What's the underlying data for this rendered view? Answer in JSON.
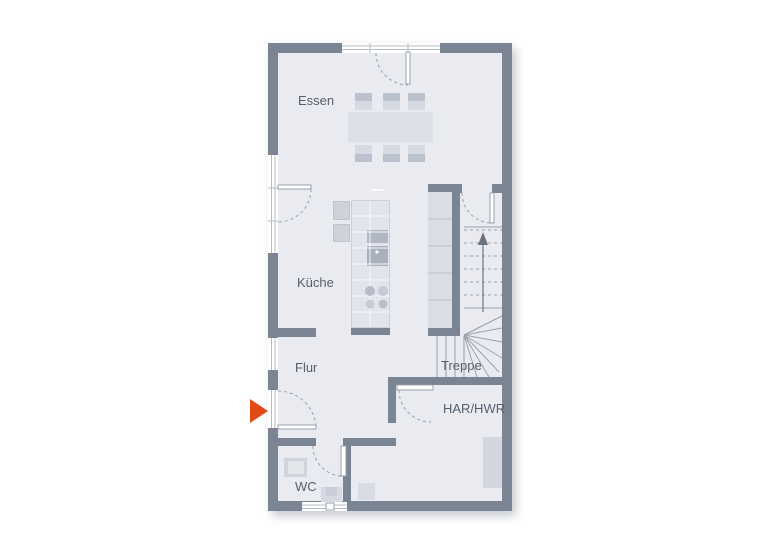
{
  "floorplan": {
    "rooms": {
      "essen": {
        "label": "Essen"
      },
      "kueche": {
        "label": "Küche"
      },
      "flur": {
        "label": "Flur"
      },
      "treppe": {
        "label": "Treppe"
      },
      "har_hwr": {
        "label": "HAR/HWR"
      },
      "wc": {
        "label": "WC"
      }
    },
    "colors": {
      "wall": "#7b8492",
      "floor": "#e9ebf1",
      "window": "#ffffff",
      "furniture_light": "#d7dbe3",
      "furniture_dark": "#bcc2cd",
      "entrance_arrow": "#e14a15",
      "label_text": "#545f6e"
    },
    "icons": {
      "entrance_arrow": "right-pointing-triangle",
      "stairs_up_arrow": "up-arrow"
    }
  }
}
